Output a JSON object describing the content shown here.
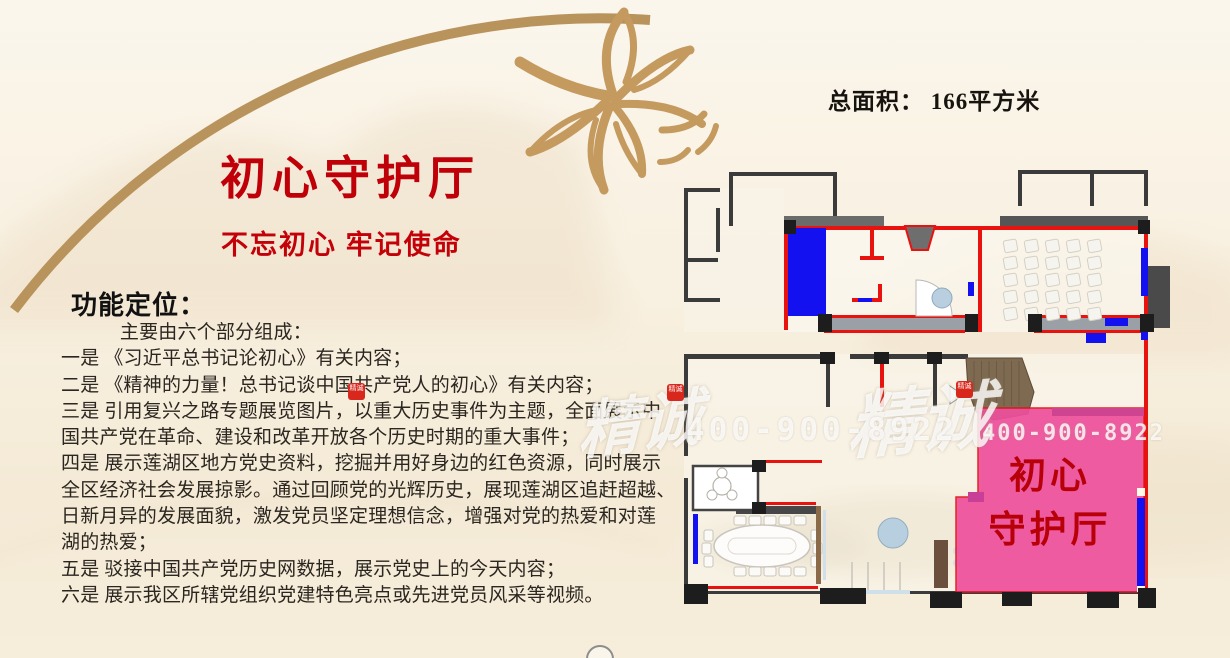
{
  "meta": {
    "total_area": "总面积： 166平方米"
  },
  "title": {
    "main": "初心守护厅",
    "subtitle": "不忘初心 牢记使命"
  },
  "functions": {
    "heading": "功能定位：",
    "intro": "主要由六个部分组成：",
    "lines": [
      "一是 《习近平总书记论初心》有关内容；",
      "二是 《精神的力量！总书记谈中国共产党人的初心》有关内容；",
      "三是 引用复兴之路专题展览图片，以重大历史事件为主题，全面展示中",
      "国共产党在革命、建设和改革开放各个历史时期的重大事件；",
      "四是 展示莲湖区地方党史资料，挖掘并用好身边的红色资源，同时展示",
      "全区经济社会发展掠影。通过回顾党的光辉历史，展现莲湖区追赶超越、",
      "日新月异的发展面貌，激发党员坚定理想信念，增强对党的热爱和对莲",
      "湖的热爱；",
      "五是 驳接中国共产党历史网数据，展示党史上的今天内容；",
      "六是 展示我区所辖党组织党建特色亮点或先进党员风采等视频。"
    ]
  },
  "floorplan": {
    "room_label": [
      "初心",
      "守护厅"
    ],
    "highlight_color": "#ee4f9c"
  },
  "watermark": {
    "phone": "400-900-8922",
    "brand": "精诚",
    "seal": "精诚"
  },
  "colors": {
    "accent_red": "#bf0008",
    "gold": "#b9935c",
    "wall_red": "#e8120e",
    "plan_blue": "#1411f0"
  }
}
